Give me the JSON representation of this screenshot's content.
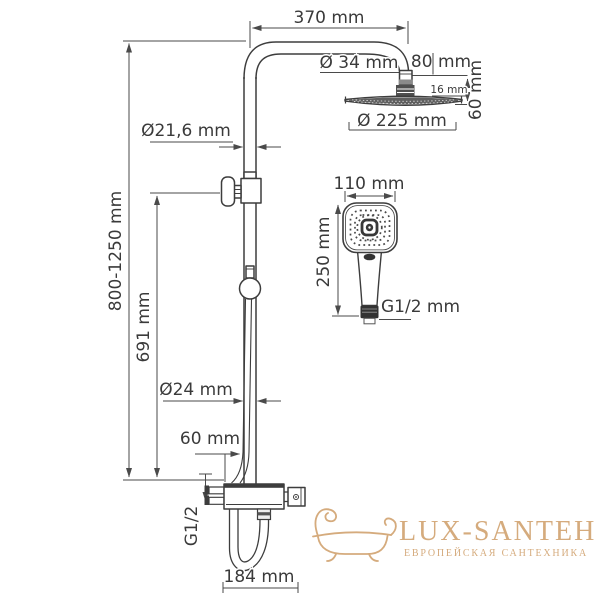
{
  "drawing": {
    "title_semantic": "shower-column-dimension-diagram",
    "dimensions": {
      "top_width": "370 mm",
      "arm_connector_diameter": "Ø 34 mm",
      "head_connection_offset": "80 mm",
      "head_edge_thickness": "16 mm",
      "head_height": "60 mm",
      "head_diameter": "Ø 225 mm",
      "upper_pipe_diameter": "Ø21,6 mm",
      "total_height": "800-1250 mm",
      "rail_height": "691 mm",
      "lower_pipe_diameter": "Ø24 mm",
      "outlet_offset": "60 mm",
      "inlet_thread": "G1/2",
      "mixer_width": "184 mm",
      "handshower_width": "110 mm",
      "handshower_length": "250 mm",
      "handshower_thread": "G1/2 mm"
    }
  },
  "watermark": {
    "brand": "LUX-SANTEH",
    "tagline": "ЕВРОПЕЙСКАЯ САНТЕХНИКА",
    "color": "#d5ab7d"
  },
  "colors": {
    "line": "#3d3d3d",
    "dimension": "#4a4a4a"
  }
}
